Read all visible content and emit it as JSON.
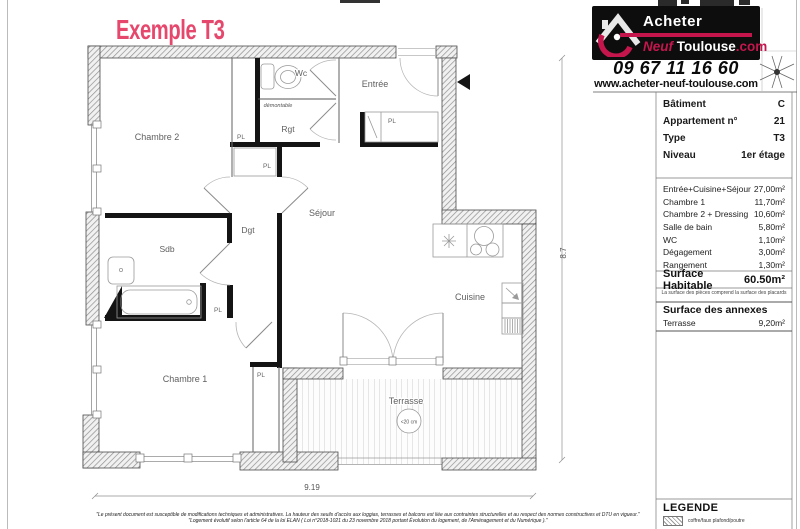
{
  "page": {
    "title": "Exemple T3"
  },
  "colors": {
    "title": "#e6486d",
    "logo_red": "#c4164d",
    "logo_bg": "#0d0d0d"
  },
  "logo": {
    "brand_top": "Acheter",
    "brand_neuf": "Neuf",
    "brand_toulouse": "Toulouse",
    "brand_com": ".com",
    "phone": "09 67 11 16 60",
    "website": "www.acheter-neuf-toulouse.com"
  },
  "info": {
    "rows": [
      {
        "label": "Bâtiment",
        "value": "C"
      },
      {
        "label": "Appartement n°",
        "value": "21"
      },
      {
        "label": "Type",
        "value": "T3"
      },
      {
        "label": "Niveau",
        "value": "1er étage"
      }
    ]
  },
  "areas": {
    "rows": [
      {
        "label": "Entrée+Cuisine+Séjour",
        "value": "27,00m²"
      },
      {
        "label": "Chambre 1",
        "value": "11,70m²"
      },
      {
        "label": "Chambre 2 + Dressing",
        "value": "10,60m²"
      },
      {
        "label": "Salle de bain",
        "value": "5,80m²"
      },
      {
        "label": "WC",
        "value": "1,10m²"
      },
      {
        "label": "Dégagement",
        "value": "3,00m²"
      },
      {
        "label": "Rangement",
        "value": "1,30m²"
      }
    ],
    "total_label": "Surface Habitable",
    "total_value": "60.50m²",
    "note": "La surface des pièces comprend la surface des placards"
  },
  "annexes": {
    "header": "Surface des annexes",
    "rows": [
      {
        "label": "Terrasse",
        "value": "9,20m²"
      }
    ]
  },
  "plan": {
    "rooms": {
      "chambre2": "Chambre 2",
      "wc": "Wc",
      "entree": "Entrée",
      "rgt": "Rgt",
      "dgt": "Dgt",
      "sejour": "Séjour",
      "sdb": "Sdb",
      "chambre1": "Chambre 1",
      "cuisine": "Cuisine",
      "terrasse": "Terrasse"
    },
    "placard": "PL",
    "demontable": "démontable",
    "terrace_note": "<20 cm",
    "dim_width": "9.19",
    "dim_height": "8.7"
  },
  "legend": {
    "title": "LEGENDE",
    "item": "coffre/faux plafond/poutre"
  },
  "disclaimer": {
    "line1": "\"Le présent document est susceptible de modifications techniques et administratives. La hauteur des seuils d'accès aux loggias, terrasses et balcons est liée aux contraintes structurelles et au respect des normes constructives et DTU en vigueur.\"",
    "line2": "\"Logement évolutif selon l'article 64 de la loi ELAN ( Loi n°2018-1021 du 23 novembre 2018 portant Évolution du logement, de l'Aménagement et du Numérique ).\""
  }
}
